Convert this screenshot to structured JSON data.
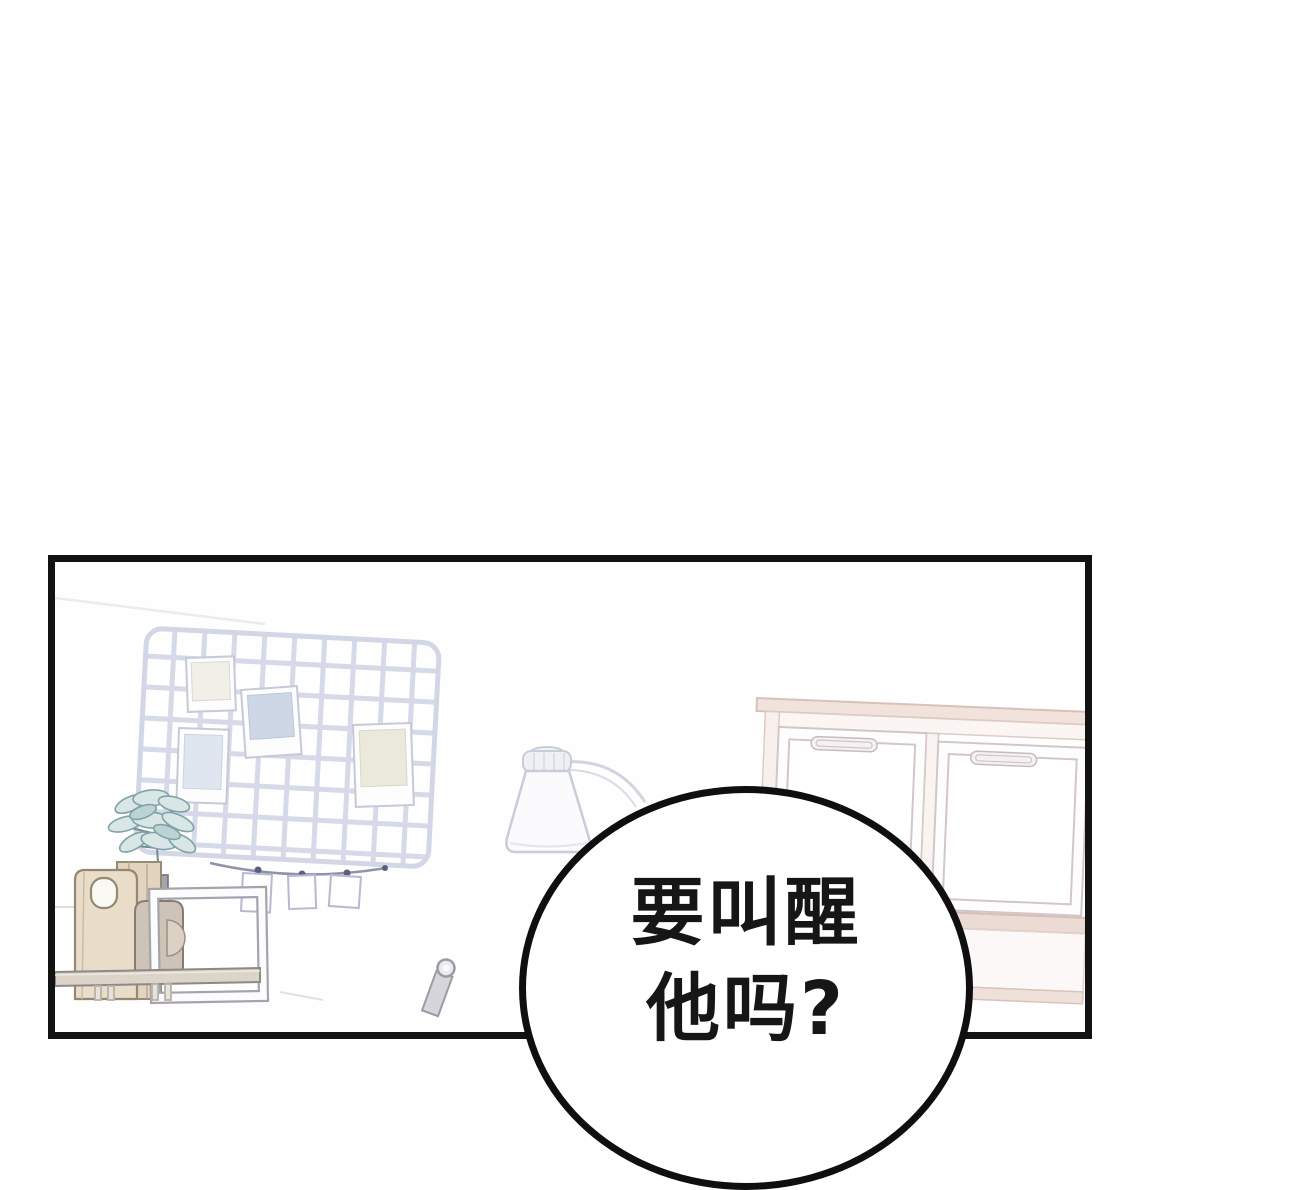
{
  "page": {
    "background": "#ffffff"
  },
  "panel": {
    "border_color": "#121212",
    "background": "#fefefe"
  },
  "speech_bubble": {
    "lines": [
      "要叫醒",
      "他吗?"
    ],
    "full_text": "要叫醒他吗?",
    "fill": "#ffffff",
    "border_color": "#0f0f0f",
    "text_color": "#161616"
  },
  "scene_colors": {
    "grid_board": "#d5d8e7",
    "photo_blue": "#cdd7e6",
    "photo_light_blue": "#dfe6ef",
    "photo_cream": "#ebe9dc",
    "plant_leaf_fill": "#d9e6e6",
    "plant_leaf_stroke": "#7fa2a7",
    "paper_bag": "#e9dcc9",
    "vase": "#cec3b7",
    "wood_shelf": "#dcd3c9",
    "window_trim": "#f1e2dc",
    "window_sill": "#ecdad4",
    "lamp_body": "#fbfbfd"
  }
}
